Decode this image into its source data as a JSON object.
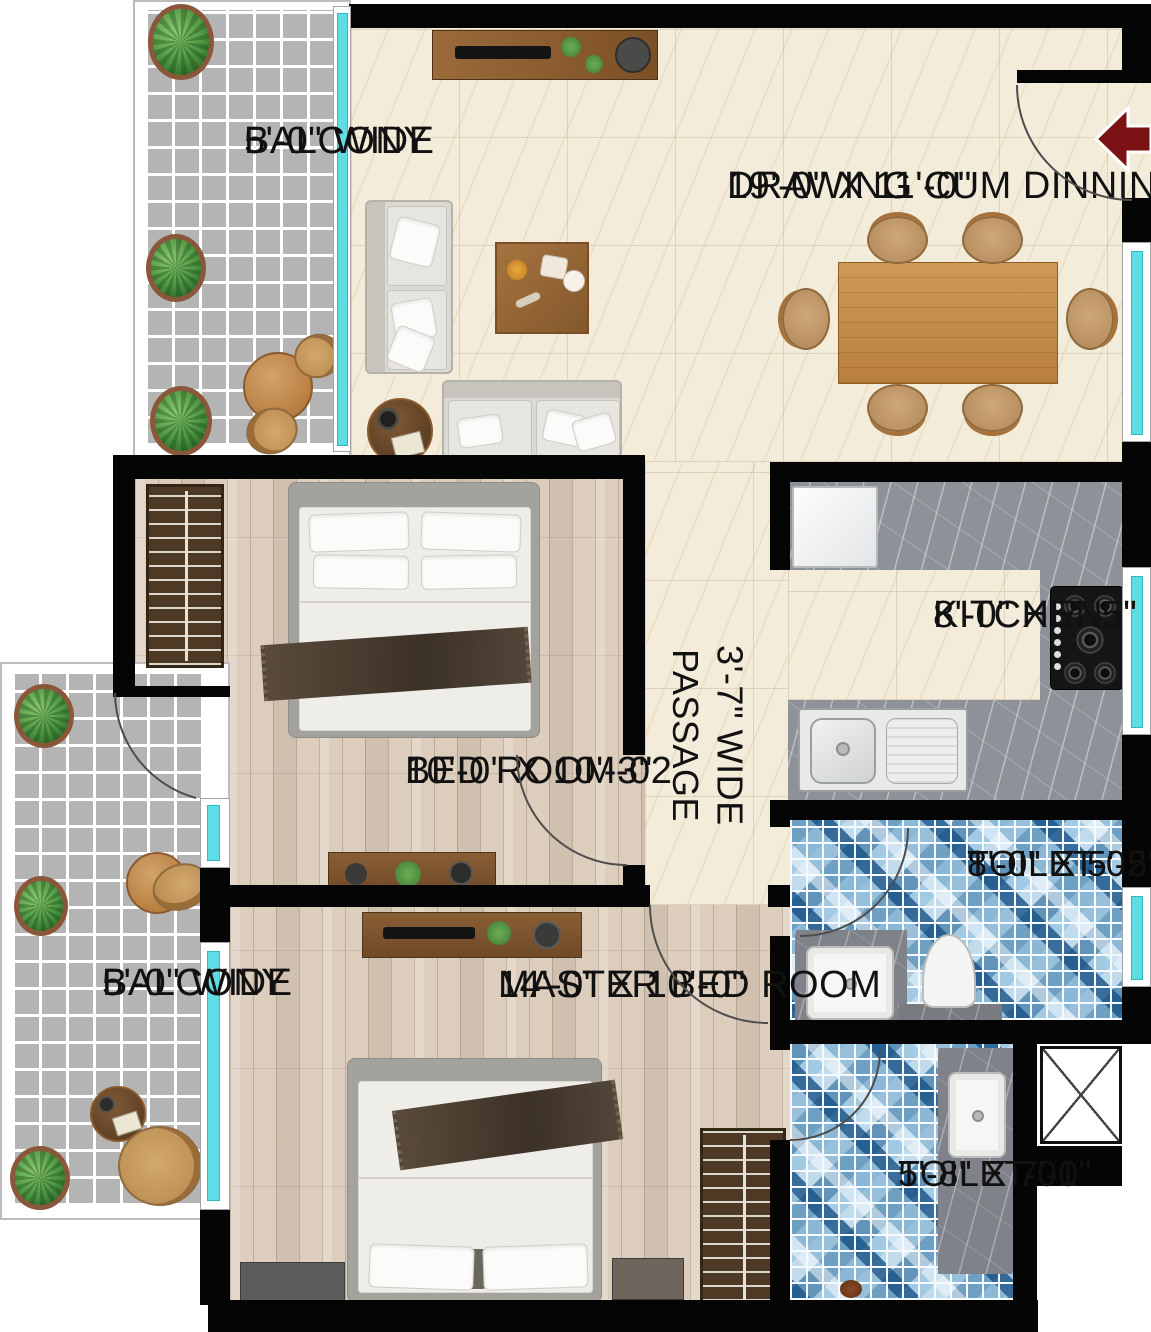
{
  "colors": {
    "wall": "#050505",
    "window_glass": "#5fdde5",
    "floor_cream": "#f4ecda",
    "floor_wood": "#dccdbd",
    "balcony_tile": "#b4b4b4",
    "mosaic_blue": "#9cc3dd",
    "counter_gray": "#8d9298",
    "entry_arrow": "#7a1114",
    "label_text": "#111111"
  },
  "rooms": {
    "balcony_top": {
      "label": "BALCONY",
      "dim": "5'-0\" WIDE"
    },
    "drawing_dining": {
      "label": "DRAWING CUM DINNING",
      "dim": "19'-0\" X 11'-0\""
    },
    "kitchen": {
      "label": "KITCHEN",
      "dim": "8'-0\" X 7'-5\""
    },
    "passage": {
      "dim": "3'-7\" WIDE",
      "label": "PASSAGE"
    },
    "bedroom_02": {
      "label": "BED ROOM-02",
      "dim": "10'-0\" X 10'-3\""
    },
    "master_bedroom": {
      "label": "MASTER BED ROOM",
      "dim": "14'-0\" X 10'-0\""
    },
    "toilet_02": {
      "label": "TOILET-02",
      "dim": "8'-0\" X 5'-5\""
    },
    "toilet_01": {
      "label": "TOILET-01",
      "dim": "5'-8\" X 7'-0\""
    },
    "balcony_bottom": {
      "label": "BALCONY",
      "dim": "5'-0\" WIDE"
    }
  }
}
